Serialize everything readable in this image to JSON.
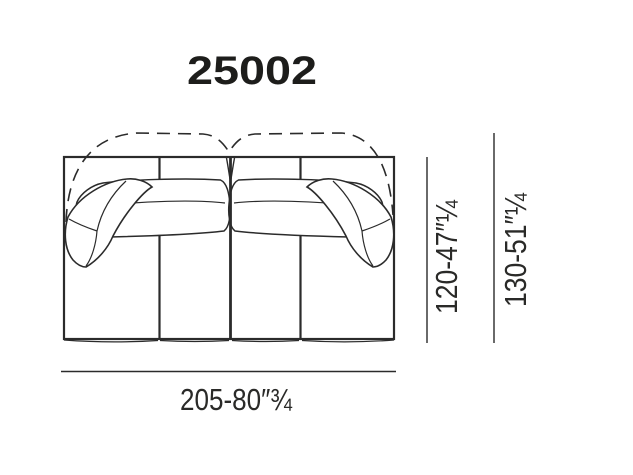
{
  "page": {
    "background": "#ffffff"
  },
  "product": {
    "code": "25002"
  },
  "drawing": {
    "type": "sofa-top-view-technical-line-drawing",
    "line_color": "#2b2b2b",
    "features": [
      "dashed high-back outline",
      "two back cushions",
      "two arm pillows",
      "four seat sections"
    ]
  },
  "dimensions": {
    "width": "205-80″¾",
    "depth": "120-47″¼",
    "depth_overall": "130-51″¼"
  }
}
